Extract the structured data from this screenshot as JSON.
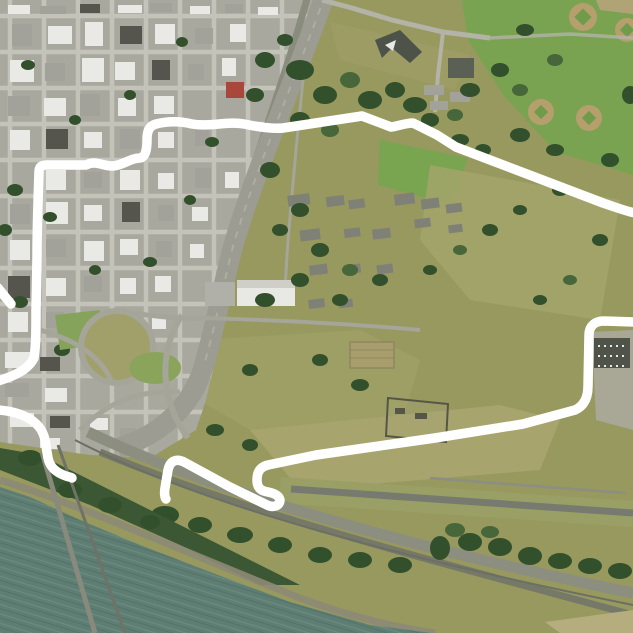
{
  "map": {
    "kind": "aerial-satellite-imagery",
    "description": "Aerial photo of a riverfront city: downtown street grid at upper left, diagonal interstate freeway with cloverleaf interchange, historic fort fields at center, airfield runway at lower right, dark green river at lower left. A thick white boundary line is drawn over the imagery outlining the historic reserve area; the line exits the frame on the right and left edges and has a small gap near the railroad at bottom left.",
    "boundary": {
      "color": "#ffffff",
      "stroke_width": 9.5,
      "main_path": "M -2,381 C 14,376 28,370 34,358 C 36,345 36,330 36,310 L 37,258 C 37,230 38,200 39,172 C 39,166 42,165 48,165 L 86,165 C 95,160 103,166 112,166 C 122,166 130,158 140,158 C 146,157 147,148 147,140 C 147,131 149,126 156,124 C 168,121 180,121 192,124 C 210,127 228,121 244,124 C 258,127 272,129 283,128 L 362,116 L 391,127 C 398,126 406,123 413,123 L 437,135 L 456,147 L 603,203 C 615,207 625,211 635,213",
      "south_path": "M 635,322 L 604,321 C 595,321 589,326 589,335 L 588,386 C 588,398 584,406 575,410 L 523,424 L 435,438 L 316,455 L 268,465 C 260,467 257,472 257,480 C 257,488 261,491 268,492 C 273,493 279,495 280,500 C 280,506 273,508 267,505 L 230,487 L 184,462 C 176,458 170,461 168,470 L 165,488 C 164,494 165,498 166,499",
      "tail_path": "M -2,410 C 12,411 26,415 34,422 C 42,428 45,436 46,446 L 48,458 C 50,468 57,473 66,476 C 69,477 71,477 72,478",
      "stub_path": "M -2,288 L 11,304"
    },
    "palette": {
      "field_olive": "#97995f",
      "urban": "#a8a89e",
      "park_green": "#7aa351",
      "lawn_green": "#79a450",
      "water": "#5e7d73",
      "water_ripple_light": "#6b8b80",
      "water_ripple_dark": "#53726a",
      "freeway": "#9c9c92",
      "runway": "#777b6f",
      "apron": "#a9a897",
      "tree_dark": "#33502c",
      "shore": "#8c8a76",
      "red_roof": "#a9473c",
      "hangar_roof": "#4f5349"
    }
  }
}
